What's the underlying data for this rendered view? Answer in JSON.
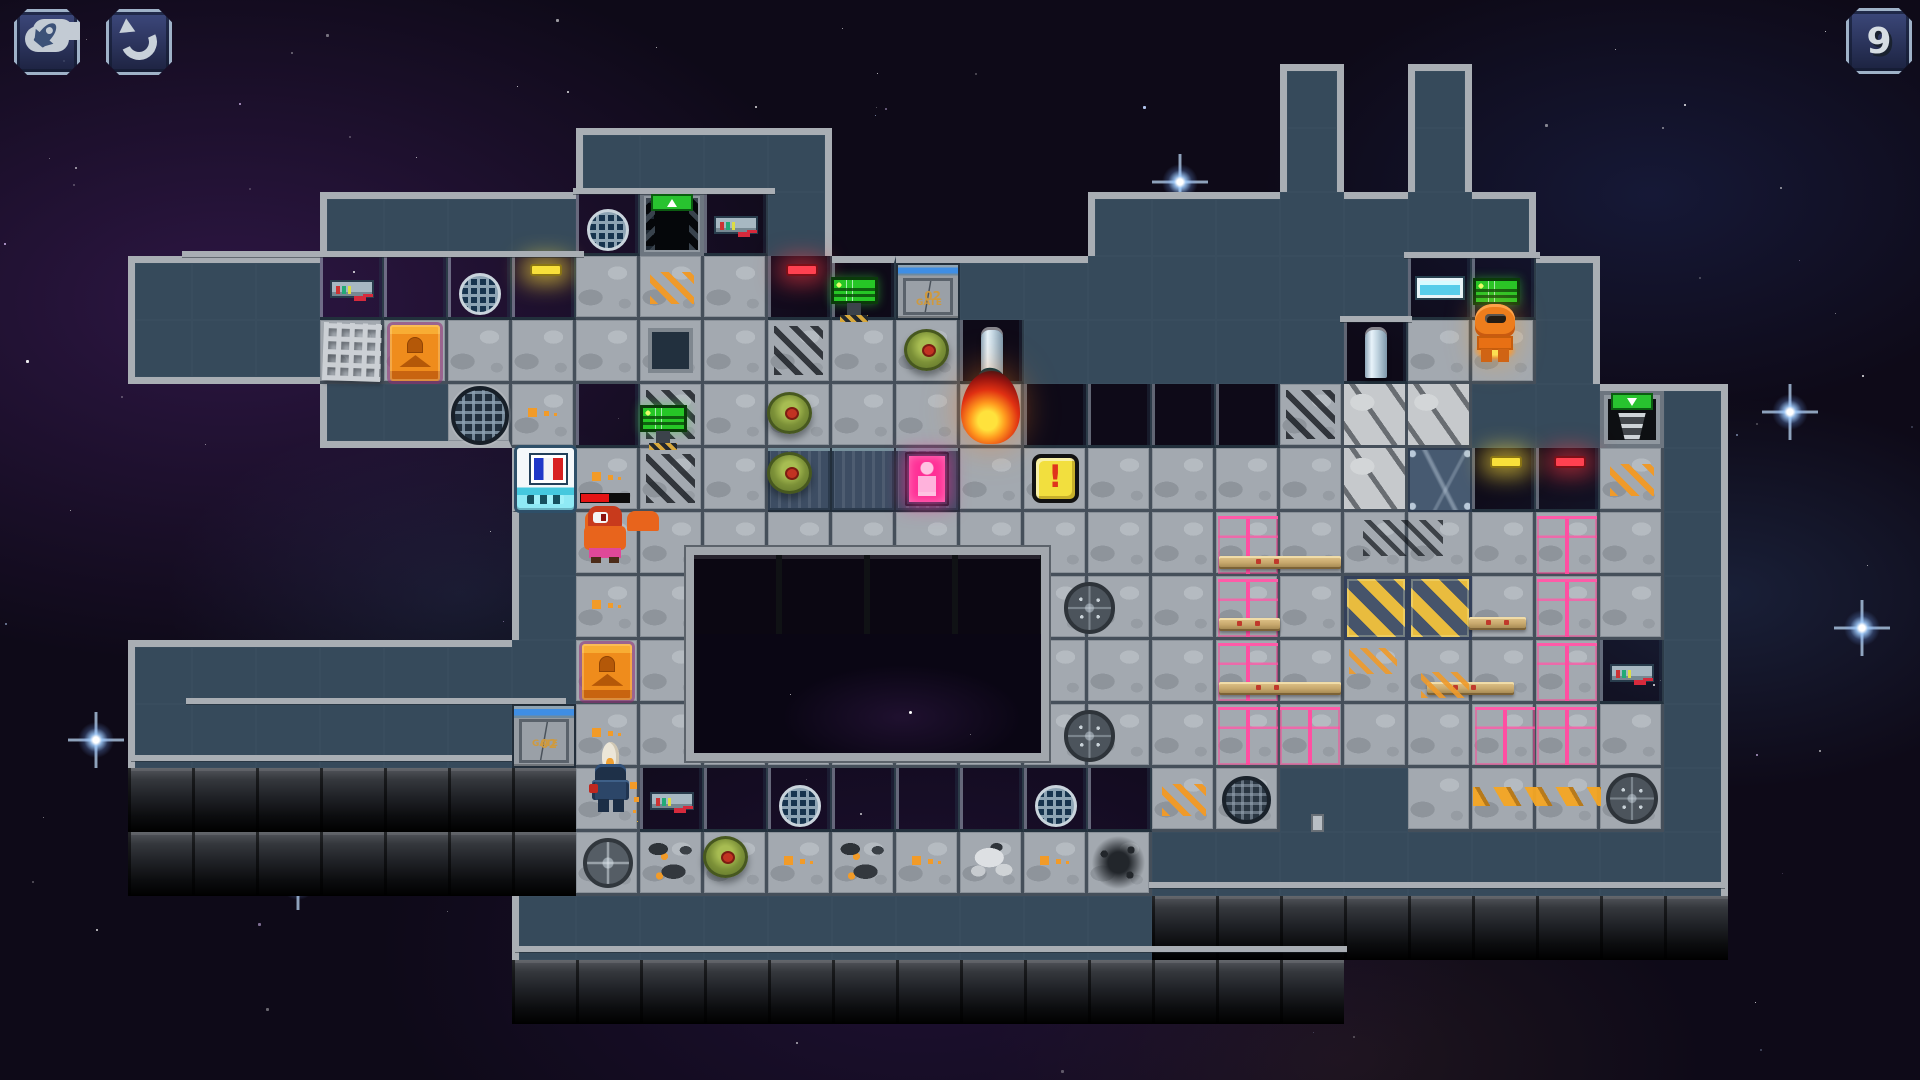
{
  "meta": {
    "width": 1920,
    "height": 1080,
    "tile_size": 64,
    "game": "pixel spaceship tactics map"
  },
  "ui": {
    "counter_label": "9",
    "buttons": [
      {
        "id": "fleet",
        "icon": "cloud-rocket-icon",
        "x": 14,
        "y": 9
      },
      {
        "id": "undo",
        "icon": "undo-arrow-icon",
        "x": 106,
        "y": 9
      },
      {
        "id": "counter",
        "icon": null,
        "x": 1846,
        "y": 8
      }
    ]
  },
  "labels": {
    "gate_name": "GATE",
    "gate_num": "02"
  },
  "colors": {
    "hull_border": "#a9aeb4",
    "hull_interior": "#364a5b",
    "floor": "#a3a9b0",
    "wall_blue": "#7390a6",
    "wall_stripe": "#3f8ee4",
    "crate_pink": "#c92050",
    "hazard_yellow": "#e9bc3e",
    "fire_orange": "#ff9a1e",
    "monitor_green": "#26c626",
    "sign_green": "#28c32f",
    "exclaim_yellow": "#f2df3e",
    "space_bg": "#0e0a18"
  },
  "map": {
    "legend": {
      ".": "space",
      "#": "hull",
      "_": "floor",
      "o": "floor-orange-dots",
      "W": "wall-blue",
      "V": "wall-vent",
      "Y": "wall-yellow-light",
      "R": "wall-red-light",
      "C": "wall-control-panel",
      "N": "wall-window",
      "P": "wall-pillar",
      "G": "gate-door",
      "E": "exit-door-up",
      "e": "exit-stairs-down",
      "X": "floor-skid-marks",
      "x": "pale-damaged",
      "c": "cracked-panel",
      "d": "floor-dark-hatch",
      "D": "dark-grate-floor",
      "H": "hazard-tile",
      "h": "floor-chevrons",
      "n": "engine-block",
      "u": "floor-debris",
      "v": "floor-white-blob",
      "s": "floor-soot",
      "q": "floor-round-grate"
    },
    "rows": [
      "..............................",
      "....................#.#.......",
      ".........####.......#.#......",
      ".....####VEC#....#######......",
      "..###CWVY_h_RWG#######NW#.....",
      "..###_____d_X__P#####P__#.....",
      ".....##_oWX_____WWWWXxx##e#...",
      "........_oX_DDD______xcYRh#...",
      "........#_________________#...",
      "........#o___________HH___#...",
      "..#######________________C#...",
      "..######Go________________#...",
      "..nnnnnnn_CWVWWWVWh_##____#...",
      "..nnnnnnnqu_ouovos#########...",
      "........##########nnnnnnnnn...",
      "........nnnnnnnnnnnnn.........",
      ".............................."
    ]
  },
  "objects": [
    {
      "type": "pit",
      "x": 10.72,
      "y": 8.55,
      "w": 5.67,
      "h": 3.34
    },
    {
      "type": "monitor",
      "x": 12.98,
      "y": 4.33,
      "stand": true
    },
    {
      "type": "monitor",
      "x": 10.0,
      "y": 6.33,
      "stand": true
    },
    {
      "type": "monitor",
      "x": 23.02,
      "y": 4.35,
      "stand": false
    },
    {
      "type": "table",
      "x": 14.12,
      "y": 5.14
    },
    {
      "type": "table",
      "x": 11.98,
      "y": 6.12
    },
    {
      "type": "table",
      "x": 11.98,
      "y": 7.06
    },
    {
      "type": "table",
      "x": 10.98,
      "y": 13.06
    },
    {
      "type": "smoke",
      "x": 10.55,
      "y": 5.82,
      "w": 1.5,
      "h": 1.05
    },
    {
      "type": "smoke",
      "x": 11.82,
      "y": 6.28,
      "w": 0.95,
      "h": 0.7
    },
    {
      "type": "fire",
      "x": 15.02,
      "y": 5.8,
      "w": 0.92,
      "h": 1.14
    },
    {
      "type": "exclaim",
      "x": 16.12,
      "y": 7.1
    },
    {
      "type": "french",
      "x": 8.08,
      "y": 7.0
    },
    {
      "type": "ocrate",
      "x": 6.1,
      "y": 5.08
    },
    {
      "type": "ocrate",
      "x": 9.1,
      "y": 10.06
    },
    {
      "type": "teleporter",
      "x": 14.14,
      "y": 7.06
    },
    {
      "type": "biggrate",
      "x": 7.04,
      "y": 6.03,
      "d": 0.92
    },
    {
      "type": "meshdebris",
      "x": 5.05,
      "y": 5.05,
      "d": 0.9
    },
    {
      "type": "manhole",
      "x": 16.62,
      "y": 9.1,
      "d": 0.8
    },
    {
      "type": "manhole",
      "x": 16.62,
      "y": 11.1,
      "d": 0.8
    },
    {
      "type": "manhole",
      "x": 25.1,
      "y": 12.08,
      "d": 0.8
    },
    {
      "type": "roundgrate",
      "x": 19.1,
      "y": 12.12,
      "d": 0.76
    },
    {
      "type": "crate",
      "x": 19.03,
      "y": 8.07
    },
    {
      "type": "crate",
      "x": 19.03,
      "y": 9.05
    },
    {
      "type": "crate",
      "x": 19.03,
      "y": 10.04
    },
    {
      "type": "crate",
      "x": 19.03,
      "y": 11.04
    },
    {
      "type": "crate",
      "x": 20.0,
      "y": 11.04
    },
    {
      "type": "crate",
      "x": 24.02,
      "y": 8.07
    },
    {
      "type": "crate",
      "x": 24.02,
      "y": 9.05
    },
    {
      "type": "crate",
      "x": 24.02,
      "y": 10.04
    },
    {
      "type": "crate",
      "x": 23.05,
      "y": 11.04
    },
    {
      "type": "crate",
      "x": 24.02,
      "y": 11.04
    },
    {
      "type": "pipe",
      "x": 19.05,
      "y": 8.68,
      "w": 1.9
    },
    {
      "type": "pipe",
      "x": 19.05,
      "y": 9.66,
      "w": 0.95
    },
    {
      "type": "pipe",
      "x": 19.05,
      "y": 10.66,
      "w": 1.9
    },
    {
      "type": "pipe",
      "x": 22.95,
      "y": 9.64,
      "w": 0.9
    },
    {
      "type": "pipe",
      "x": 22.3,
      "y": 10.66,
      "w": 1.35
    },
    {
      "type": "hazardstrip",
      "x": 23.02,
      "y": 12.3,
      "w": 2.0
    },
    {
      "type": "chevsmall",
      "x": 21.08,
      "y": 10.12
    },
    {
      "type": "chevsmall",
      "x": 22.2,
      "y": 10.5
    },
    {
      "type": "skidsmall",
      "x": 21.3,
      "y": 8.12
    },
    {
      "type": "switch",
      "x": 20.48,
      "y": 12.72
    },
    {
      "type": "enemy",
      "x": 9.12,
      "y": 7.9
    },
    {
      "type": "knight",
      "x": 9.22,
      "y": 11.6
    },
    {
      "type": "astronaut",
      "x": 23.0,
      "y": 4.72
    },
    {
      "type": "hline",
      "x": 2.85,
      "y": 3.92,
      "w": 6.28
    },
    {
      "type": "hline",
      "x": 8.95,
      "y": 2.93,
      "w": 3.16
    },
    {
      "type": "hline",
      "x": 21.94,
      "y": 3.93,
      "w": 2.12
    },
    {
      "type": "hline",
      "x": 20.94,
      "y": 4.93,
      "w": 1.12
    },
    {
      "type": "hline",
      "x": 2.9,
      "y": 10.9,
      "w": 5.95
    },
    {
      "type": "hline",
      "x": 2.05,
      "y": 11.8,
      "w": 5.95
    },
    {
      "type": "hline",
      "x": 8.05,
      "y": 14.78,
      "w": 13.0
    },
    {
      "type": "hline",
      "x": 17.95,
      "y": 13.78,
      "w": 9.0
    }
  ],
  "background": {
    "bright_stars": [
      {
        "x": 1790,
        "y": 412
      },
      {
        "x": 1180,
        "y": 182
      },
      {
        "x": 1862,
        "y": 628
      },
      {
        "x": 96,
        "y": 740
      },
      {
        "x": 298,
        "y": 882
      }
    ]
  }
}
